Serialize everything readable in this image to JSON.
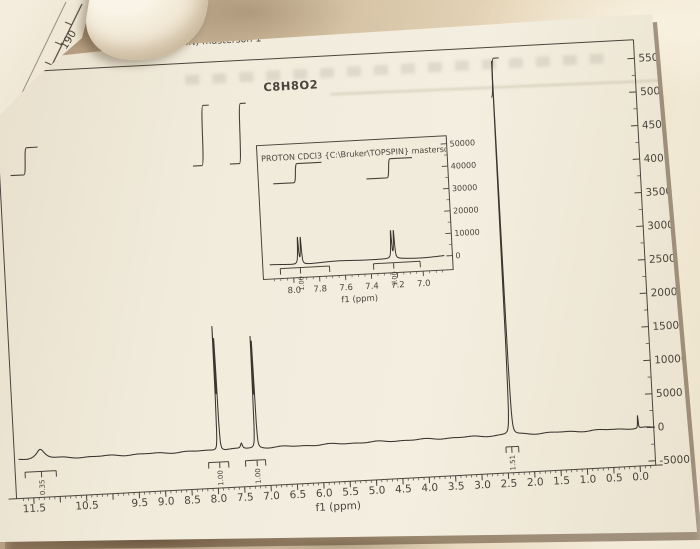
{
  "photo": {
    "paper_color": "#f1ebdc",
    "fabric_color": "#c9b49b",
    "ink_color": "#4a443c"
  },
  "paper": {
    "title": "PROTON CDCl3 (C:\\Bruker\\TOPSPIN) masterson 1",
    "formula": "C8H8O2"
  },
  "under_sheet": {
    "axis_labels": [
      "190",
      "200"
    ]
  },
  "chart_data": [
    {
      "type": "line",
      "role": "main-1h-nmr-spectrum",
      "title": "PROTON CDCl3 (C:\\Bruker\\TOPSPIN) masterson 1",
      "xlabel": "f1 (ppm)",
      "xlim": [
        11.75,
        -0.32
      ],
      "ylim": [
        -5000,
        57500
      ],
      "x_major_step": 0.5,
      "x_minor_step": 0.1,
      "x_labeled_ticks": [
        11.5,
        10.5,
        9.5,
        9.0,
        8.5,
        8.0,
        7.5,
        7.0,
        6.5,
        6.0,
        5.5,
        5.0,
        4.5,
        4.0,
        3.5,
        3.0,
        2.5,
        2.0,
        1.5,
        1.0,
        0.5,
        0.0
      ],
      "y_ticks": [
        55000,
        50000,
        45000,
        40000,
        35000,
        30000,
        25000,
        20000,
        15000,
        10000,
        5000,
        0,
        -5000
      ],
      "grid": false,
      "legend": false,
      "peaks": [
        {
          "ppm": 11.33,
          "height": 1500,
          "width": 0.1,
          "label": "0.35",
          "span": [
            11.64,
            11.05
          ],
          "curve": {
            "span": [
              11.62,
              11.08
            ],
            "y": [
              155,
              128
            ]
          }
        },
        {
          "ppm": 7.95,
          "height": 19000,
          "width": 0.006,
          "doublet": 0.022,
          "label": "1.00",
          "span": [
            8.16,
            7.78
          ],
          "curve": {
            "span": [
              8.16,
              7.8
            ],
            "y": [
              155,
              95
            ]
          }
        },
        {
          "ppm": 7.52,
          "height": 800,
          "width": 0.02
        },
        {
          "ppm": 7.24,
          "height": 17000,
          "width": 0.006,
          "doublet": 0.022,
          "label": "1.00",
          "span": [
            7.46,
            7.08
          ],
          "curve": {
            "span": [
              7.46,
              7.1
            ],
            "y": [
              155,
              95
            ]
          }
        },
        {
          "ppm": 2.41,
          "height": 56500,
          "width": 0.007,
          "label": "1.51",
          "span": [
            2.52,
            2.28
          ],
          "curve": {
            "span": [
              2.45,
              2.27
            ],
            "y": [
              102,
              63
            ]
          }
        },
        {
          "ppm": 0.0,
          "height": 2100,
          "width": 0.006
        }
      ]
    },
    {
      "type": "line",
      "role": "inset-aromatic-expansion",
      "title": "PROTON CDCl3 {C:\\Bruker\\TOPSPIN} masterso",
      "xlabel": "f1 (ppm)",
      "xlim": [
        8.18,
        6.83
      ],
      "ylim": [
        0,
        55000
      ],
      "x_major_step": 0.2,
      "x_minor_step": 0.05,
      "x_labeled_ticks": [
        8.0,
        7.8,
        7.6,
        7.4,
        7.2,
        7.0
      ],
      "y_ticks": [
        50000,
        40000,
        30000,
        20000,
        10000,
        0
      ],
      "grid": false,
      "legend": false,
      "peaks": [
        {
          "ppm": 7.945,
          "height": 12800,
          "width": 0.0045,
          "doublet": 0.022,
          "label": "1.00",
          "span": [
            8.1,
            7.72
          ],
          "curve": {
            "span": [
              8.12,
              7.74
            ],
            "y": [
              177,
              158
            ]
          }
        },
        {
          "ppm": 7.225,
          "height": 13300,
          "width": 0.0045,
          "doublet": 0.022,
          "label": "1.00",
          "span": [
            7.38,
            7.02
          ],
          "curve": {
            "span": [
              7.4,
              7.04
            ],
            "y": [
              177,
              158
            ]
          }
        }
      ]
    }
  ]
}
